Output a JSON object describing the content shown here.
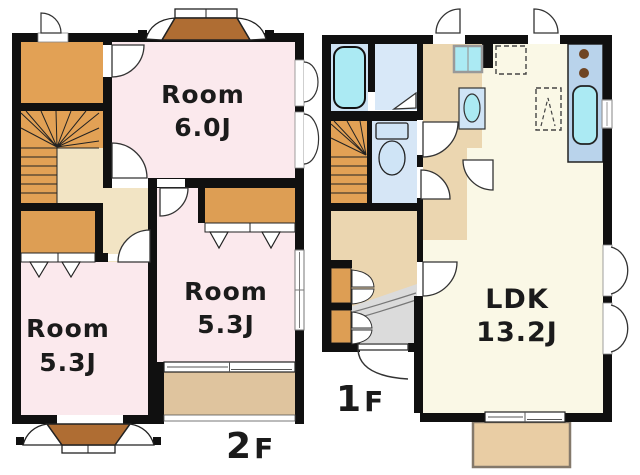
{
  "floor_2f": {
    "floor_label": {
      "number": "2",
      "suffix": "F"
    },
    "rooms": [
      {
        "name": "Room",
        "size": "6.0J"
      },
      {
        "name": "Room",
        "size": "5.3J"
      },
      {
        "name": "Room",
        "size": "5.3J"
      }
    ]
  },
  "floor_1f": {
    "floor_label": {
      "number": "1",
      "suffix": "F"
    },
    "rooms": [
      {
        "name": "LDK",
        "size": "13.2J"
      }
    ]
  },
  "colors": {
    "wall": "#101010",
    "room_pink": "#FBE9ED",
    "wood_orange": "#E2A155",
    "closet_orange": "#DD9E54",
    "hall_cream": "#F2E4C4",
    "hall_tan": "#EBD6B0",
    "balcony_tan": "#DFC49E",
    "ldk_ivory": "#FAF8E6",
    "bath_blue": "#CEE2F3",
    "washroom_blue": "#D8E8F8",
    "toilet_blue": "#D6E6F6",
    "kitchen_counter_blue": "#B9D3EB",
    "fixture_cyan": "#ABEAF3",
    "fixture_blue": "#CFE4F6",
    "bay_brown": "#AF6D33",
    "entrance_gray": "#DBDBDB",
    "deck_tan": "#E9CDA4",
    "burner_brown": "#6F4523",
    "white": "#FFFFFF",
    "text": "#1B1B1B"
  }
}
